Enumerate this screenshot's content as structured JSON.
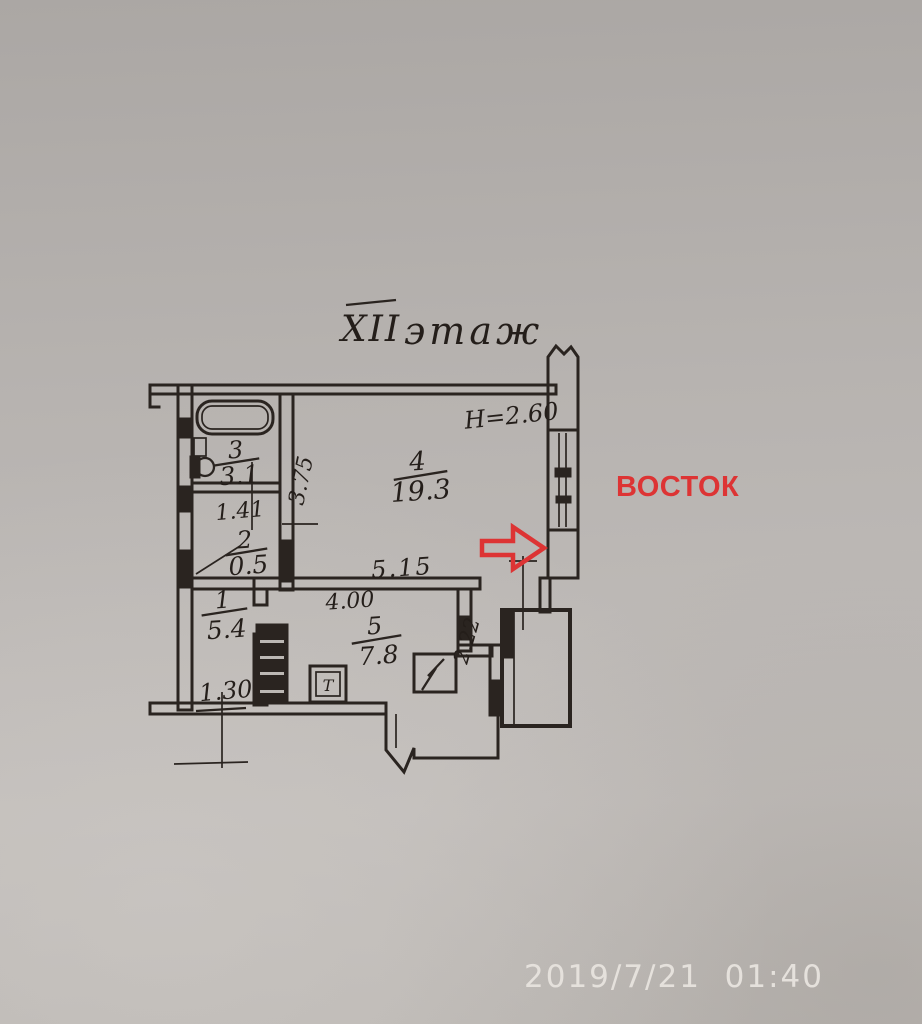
{
  "plan": {
    "floor_title_roman": "XII",
    "floor_title_word": "этаж",
    "ceiling_height": "H=2.60",
    "rooms": {
      "bathroom": {
        "number": "3",
        "area": "3.1"
      },
      "storage": {
        "number": "2",
        "area": "0.5"
      },
      "hallway": {
        "number": "1",
        "area": "5.4"
      },
      "living_room": {
        "number": "4",
        "area": "19.3"
      },
      "kitchen": {
        "number": "5",
        "area": "7.8"
      }
    },
    "dimensions": {
      "bathroom_width": "1.41",
      "living_depth": "3.75",
      "living_width": "5.15",
      "kitchen_width": "4.00",
      "kitchen_depth": "2.22",
      "hall_width": "1.30"
    },
    "stove_label": "Т"
  },
  "annotations": {
    "east_direction": "ВОСТОК",
    "annotation_color": "#dd3434",
    "timestamp": "2019/7/21  01:40"
  }
}
